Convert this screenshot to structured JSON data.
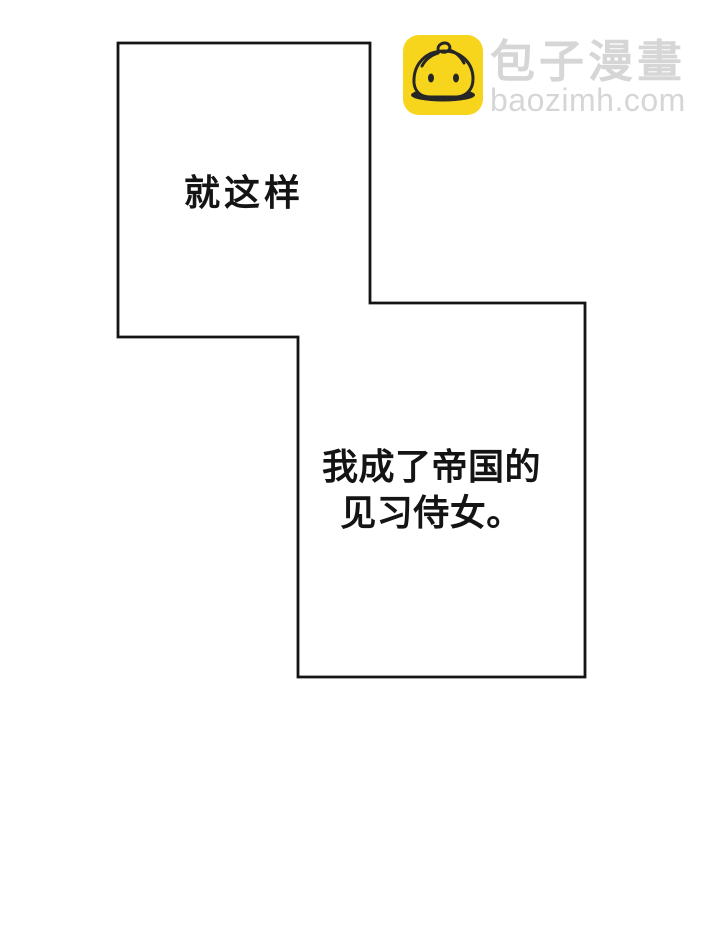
{
  "page": {
    "width": 720,
    "height": 947,
    "background": "#ffffff"
  },
  "panel_style": {
    "border_color": "#141414",
    "fill": "#ffffff",
    "text_color": "#141414"
  },
  "panels": [
    {
      "name": "panel-top",
      "text": "就这样"
    },
    {
      "name": "panel-bottom",
      "lines": [
        "我成了帝国的",
        "见习侍女。"
      ]
    }
  ],
  "watermark": {
    "icon": "baozi-bun-icon",
    "icon_bg": "#F7D51D",
    "icon_line_color": "#262626",
    "site_name": "包子漫畫",
    "site_url": "baozimh.com",
    "text_color": "#d6d6d6"
  }
}
